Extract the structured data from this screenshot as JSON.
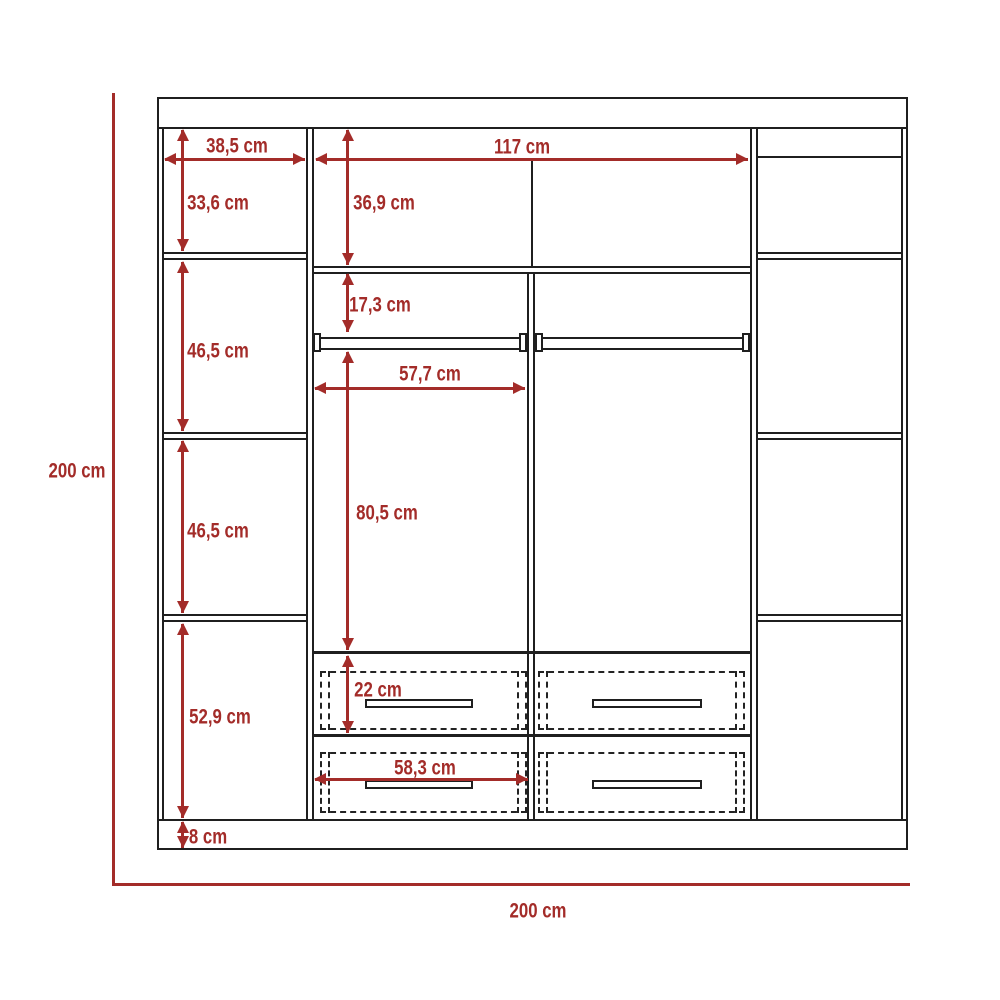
{
  "title": "Wardrobe dimensional drawing",
  "unit": "cm",
  "colors": {
    "dimension_red": "#A32C29",
    "outline_black": "#1F1F1F",
    "background": "#FFFFFF"
  },
  "overall": {
    "height": "200 cm",
    "width": "200 cm",
    "height_value_cm": 200,
    "width_value_cm": 200
  },
  "dims": {
    "left_shelf_width": "38,5 cm",
    "left_top_cell_height": "33,6 cm",
    "center_width": "117 cm",
    "center_top_cell_height": "36,9 cm",
    "rod_drop_height": "17,3 cm",
    "hanging_cell_width": "57,7 cm",
    "hanging_cell_height": "80,5 cm",
    "left_cell2_height": "46,5 cm",
    "left_cell3_height": "46,5 cm",
    "left_cell4_height": "52,9 cm",
    "base_height": "8 cm",
    "drawer_height": "22 cm",
    "drawer_width": "58,3 cm"
  },
  "values_cm": {
    "left_shelf_width": 38.5,
    "left_top_cell_height": 33.6,
    "center_width": 117,
    "center_top_cell_height": 36.9,
    "rod_drop_height": 17.3,
    "hanging_cell_width": 57.7,
    "hanging_cell_height": 80.5,
    "left_cell2_height": 46.5,
    "left_cell3_height": 46.5,
    "left_cell4_height": 52.9,
    "base_height": 8,
    "drawer_height": 22,
    "drawer_width": 58.3
  },
  "components": {
    "drawers": 4,
    "hanging_rods": 2,
    "side_columns": 2
  }
}
